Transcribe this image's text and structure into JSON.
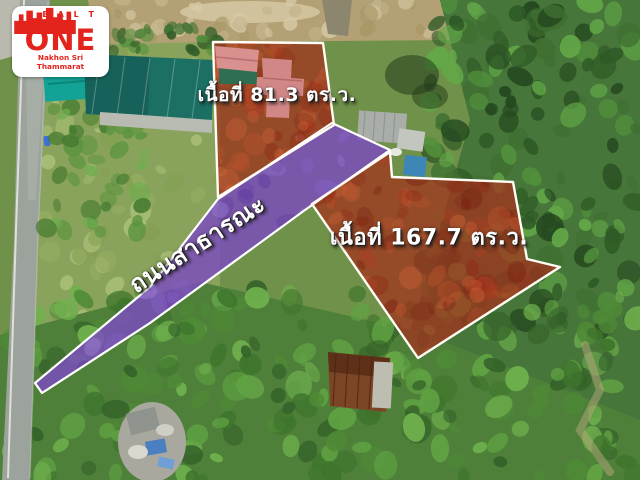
{
  "brand": {
    "name_top": "R E A L T Y",
    "name_main": "ONE",
    "location": "Nakhon Sri Thammarat",
    "icon": "city-skyline-icon",
    "color": "#e2241d"
  },
  "annotations": {
    "plot_small": {
      "label": "เนื้อที่ 81.3 ตร.ว."
    },
    "plot_large": {
      "label": "เนื้อที่ 167.7 ตร.ว."
    },
    "road": {
      "label": "ถนนสาธารณะ"
    }
  },
  "colors": {
    "plot_overlay": "#a2331d",
    "road_overlay": "#7b4cc0",
    "outline": "#ffffff",
    "label_text": "#ffffff"
  }
}
